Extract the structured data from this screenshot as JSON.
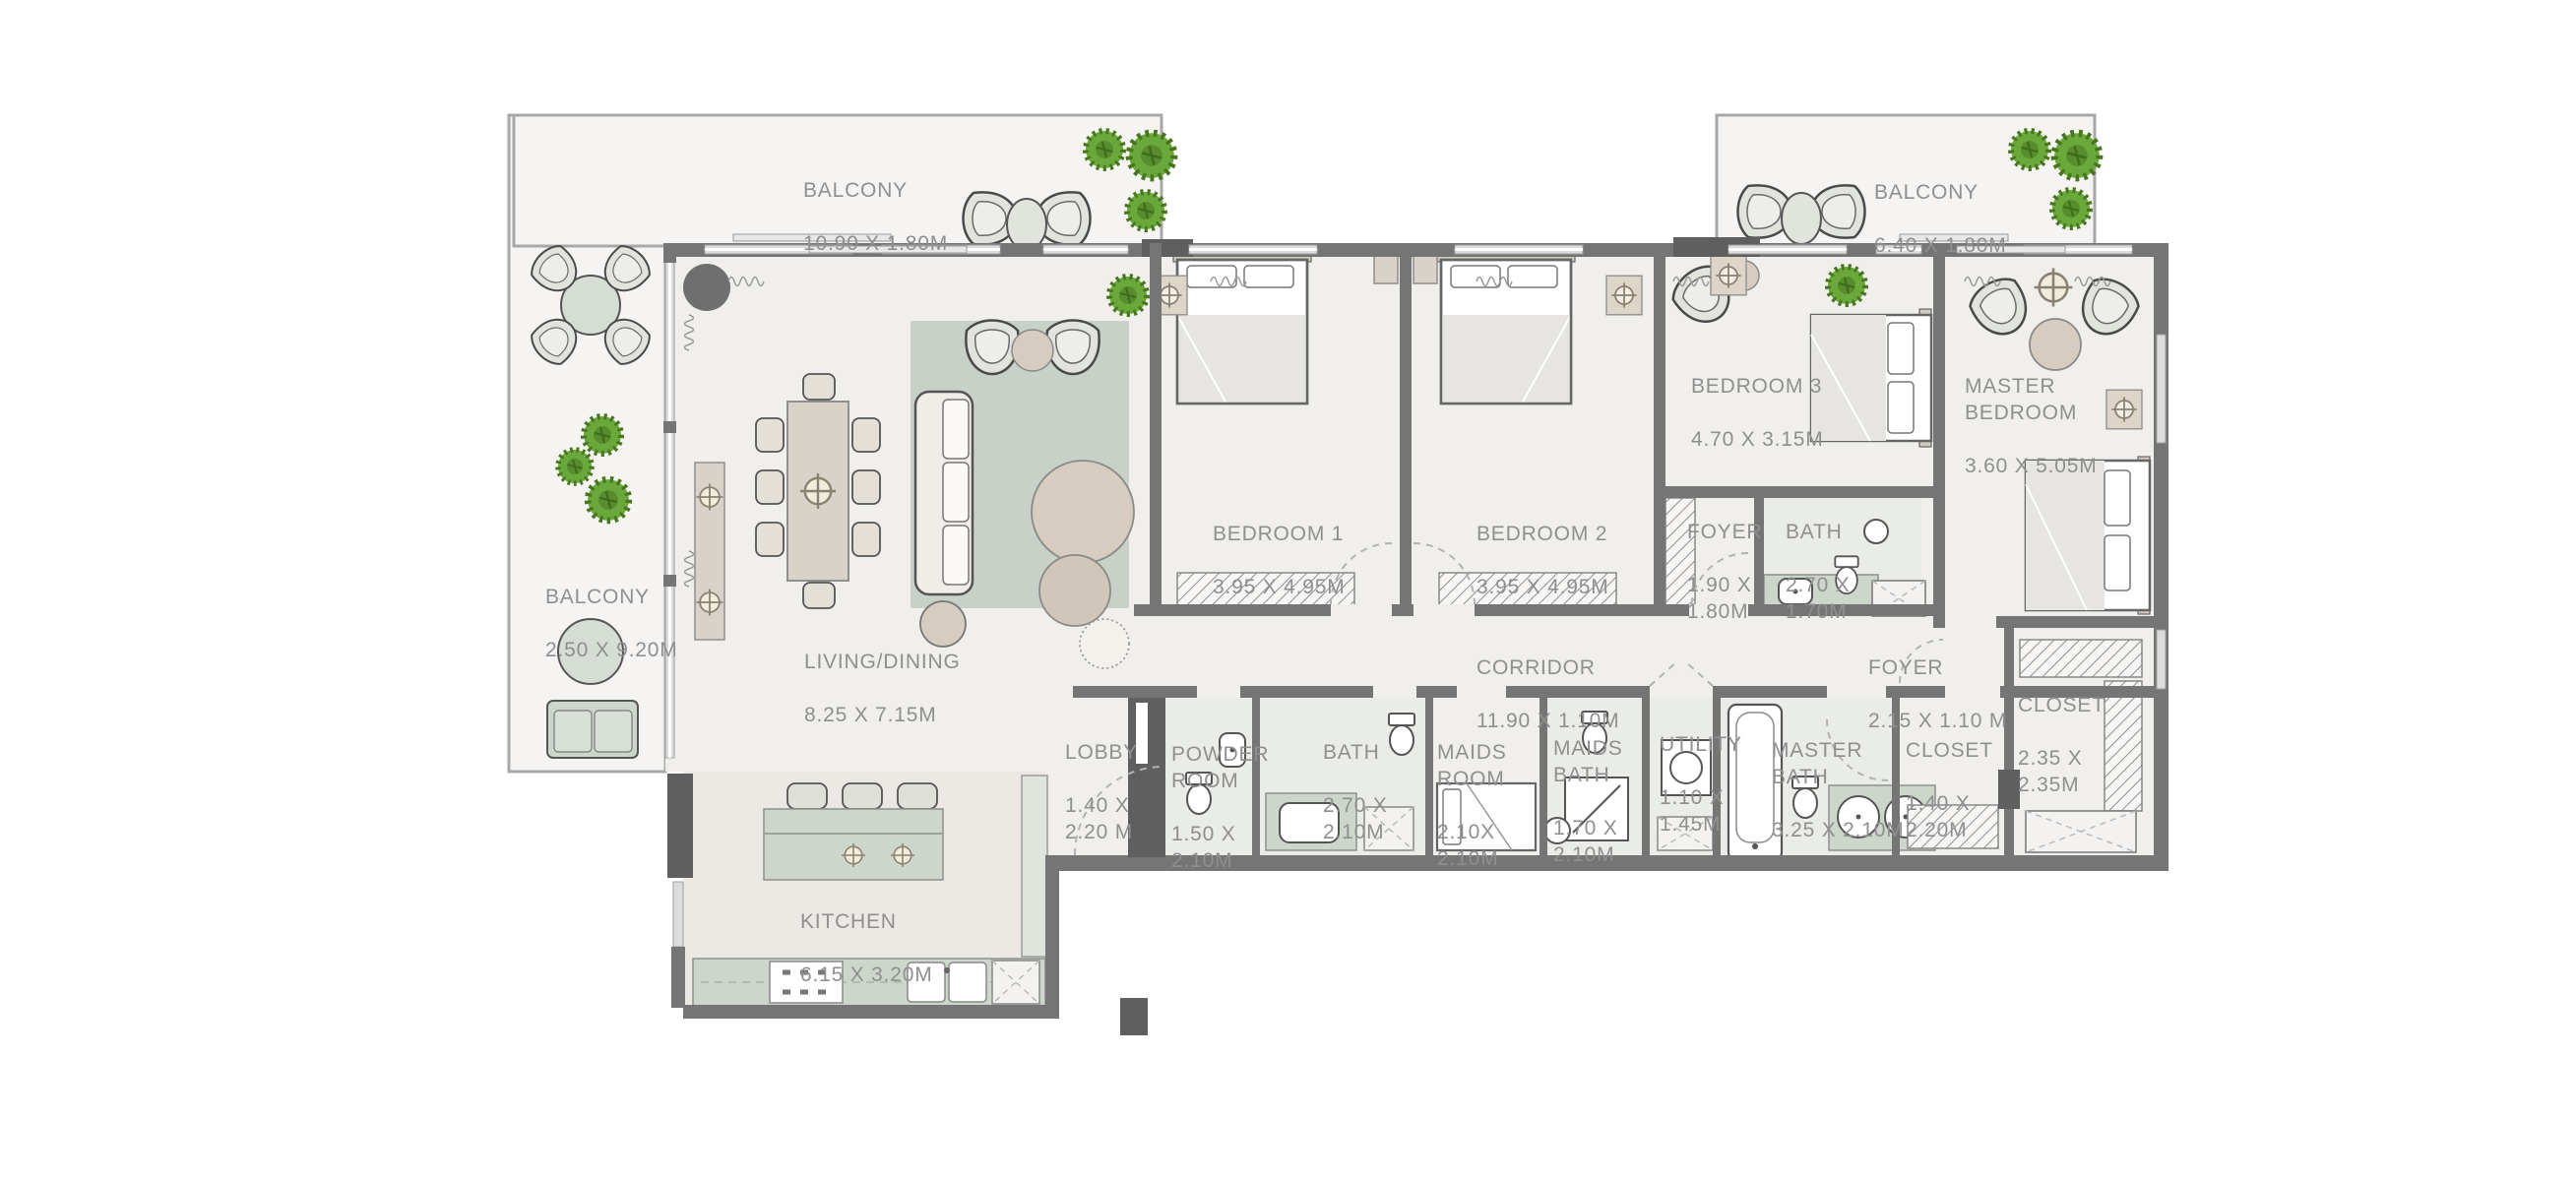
{
  "plan": {
    "title": "3 bedroom + maid apartment floor plan",
    "rooms": {
      "balcony_top": {
        "name": "BALCONY",
        "dims": "10.90 X 1.80M"
      },
      "balcony_top_right": {
        "name": "BALCONY",
        "dims": "6.40 X 1.80M"
      },
      "balcony_left": {
        "name": "BALCONY",
        "dims": "2.50 X 9.20M"
      },
      "living_dining": {
        "name": "LIVING/DINING",
        "dims": "8.25 X 7.15M"
      },
      "kitchen": {
        "name": "KITCHEN",
        "dims": "6.15 X 3.20M"
      },
      "bedroom1": {
        "name": "BEDROOM 1",
        "dims": "3.95 X 4.95M"
      },
      "bedroom2": {
        "name": "BEDROOM 2",
        "dims": "3.95 X 4.95M"
      },
      "bedroom3": {
        "name": "BEDROOM 3",
        "dims": "4.70 X 3.15M"
      },
      "master_bedroom": {
        "name": "MASTER\nBEDROOM",
        "dims": "3.60 X 5.05M"
      },
      "foyer1": {
        "name": "FOYER",
        "dims": "1.90 X\n1.80M"
      },
      "bath1": {
        "name": "BATH",
        "dims": "2.70 X\n1.70M"
      },
      "corridor": {
        "name": "CORRIDOR",
        "dims": "11.90 X 1.10M"
      },
      "foyer2": {
        "name": "FOYER",
        "dims": "2.15 X 1.10 M"
      },
      "walkin_closet": {
        "name": "CLOSET",
        "dims": "2.35 X\n2.35M"
      },
      "closet2": {
        "name": "CLOSET",
        "dims": "1.40 X\n2.20M"
      },
      "lobby": {
        "name": "LOBBY",
        "dims": "1.40 X\n2.20 M"
      },
      "powder_room": {
        "name": "POWDER\nROOM",
        "dims": "1.50 X\n2.10M"
      },
      "bath2": {
        "name": "BATH",
        "dims": "2.70 X\n2.10M"
      },
      "maids_room": {
        "name": "MAIDS\nROOM",
        "dims": "2.10X\n2.10M"
      },
      "maids_bath": {
        "name": "MAIDS\nBATH",
        "dims": "1.70 X\n2.10M"
      },
      "utility": {
        "name": "UTILITY",
        "dims": "1.10 X\n1.45M"
      },
      "master_bath": {
        "name": "MASTER\nBATH",
        "dims": "3.25 X 2.10M"
      }
    },
    "colors": {
      "wall": "#757575",
      "wallDark": "#5f5f5f",
      "floor": "#f1efec",
      "balconyFloor": "#f5f4f2",
      "kitchenFloor": "#ece8e3",
      "bathFloor": "#e9ece7",
      "sage": "#ccd6cb",
      "sageLight": "#dfe5dd",
      "beige": "#d9d2c8",
      "rugColor": "#c8d1c8",
      "plant": "#6aa83c",
      "label": "#8f8f8f",
      "glass": "#dcdcdc",
      "arc": "#b3b3b3",
      "blanket": "#e7e5e1"
    }
  }
}
